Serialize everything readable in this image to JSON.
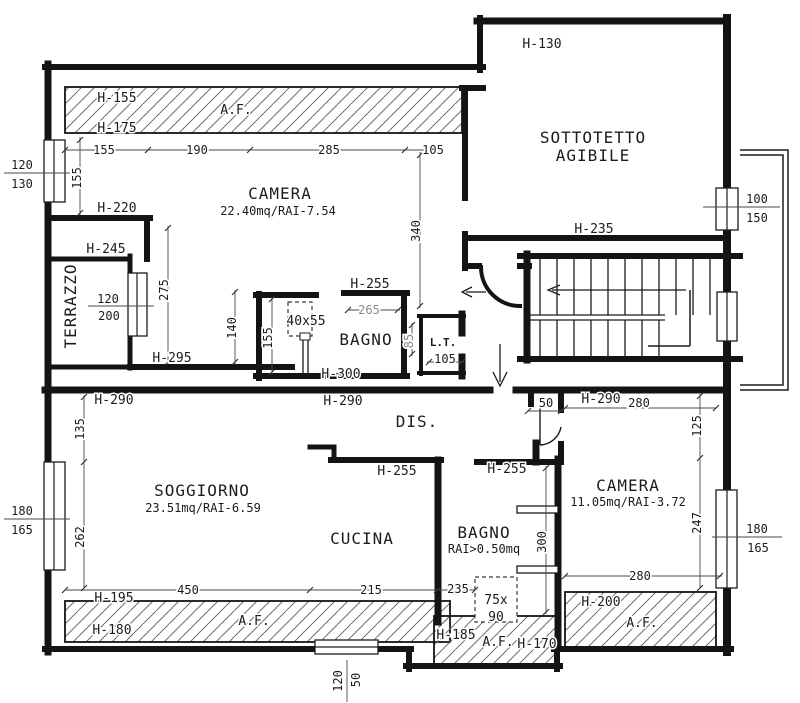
{
  "plan": {
    "af": "A.F.",
    "rooms": {
      "camera1": {
        "name": "CAMERA",
        "detail": "22.40mq/RAI-7.54"
      },
      "soggiorno": {
        "name": "SOGGIORNO",
        "detail": "23.51mq/RAI-6.59"
      },
      "cucina": {
        "name": "CUCINA"
      },
      "bagno1": {
        "name": "BAGNO"
      },
      "bagno2": {
        "name": "BAGNO",
        "detail": "RAI>0.50mq"
      },
      "camera2": {
        "name": "CAMERA",
        "detail": "11.05mq/RAI-3.72"
      },
      "dis": {
        "name": "DIS."
      },
      "lt": {
        "name": "L.T."
      },
      "terrazzo": {
        "name": "TERRAZZO"
      },
      "sottotetto": {
        "line1": "SOTTOTETTO",
        "line2": "AGIBILE"
      }
    },
    "heights": {
      "h130": "H-130",
      "h155": "H-155",
      "h170": "H-170",
      "h175": "H-175",
      "h180": "H-180",
      "h185": "H-185",
      "h195": "H-195",
      "h200": "H-200",
      "h220": "H-220",
      "h235": "H-235",
      "h245": "H-245",
      "h255": "H-255",
      "h290": "H-290",
      "h295": "H-295",
      "h300": "H-300"
    },
    "dims": {
      "d50": "50",
      "d85": "85",
      "d105": "105",
      "d125": "125",
      "d135": "135",
      "d140": "140",
      "d155": "155",
      "d190": "190",
      "d215": "215",
      "d235": "235",
      "d247": "247",
      "d262": "262",
      "d265": "265",
      "d275": "275",
      "d280": "280",
      "d285": "285",
      "d300": "300",
      "d340": "340",
      "d450": "450"
    },
    "windows": {
      "w120_130": {
        "a": "120",
        "b": "130"
      },
      "w120_200": {
        "a": "120",
        "b": "200"
      },
      "w100_150": {
        "a": "100",
        "b": "150"
      },
      "w180_165": {
        "a": "180",
        "b": "165"
      },
      "w120_50": {
        "a": "120",
        "b": "50"
      }
    },
    "fixtures": {
      "shower": "40x55",
      "skylight_a": "75x",
      "skylight_b": "90"
    }
  }
}
